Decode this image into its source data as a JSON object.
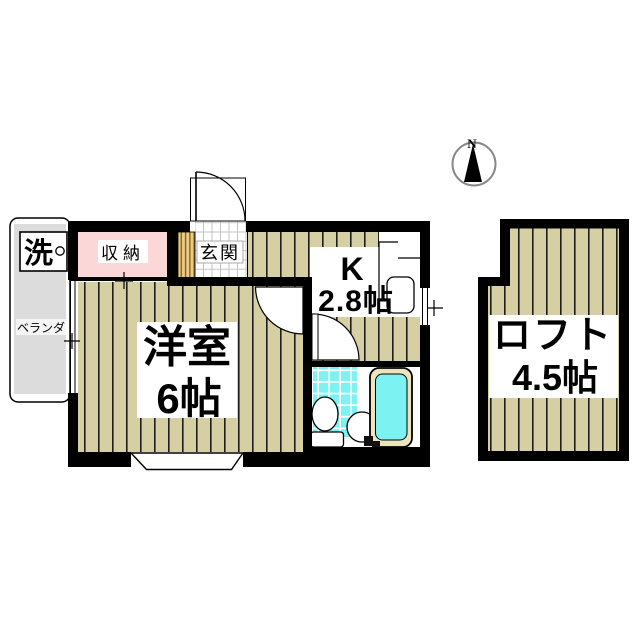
{
  "compass": {
    "north": "N"
  },
  "rooms": {
    "main_room": {
      "name": "洋室",
      "size": "6帖"
    },
    "kitchen": {
      "name": "K",
      "size": "2.8帖"
    },
    "loft": {
      "name": "ロフト",
      "size": "4.5帖"
    }
  },
  "labels": {
    "closet": "収納",
    "entrance": "玄関",
    "veranda": "ベランダ",
    "washer": "洗"
  },
  "colors": {
    "floor-beige": "#d6cfa4",
    "stripe-dark": "#1e1e1e",
    "closet-pink": "#fbd7d7",
    "tile-cyan": "#7df2f2",
    "tub-rim": "#ece4bc",
    "veranda-gray": "#dcdcdc",
    "shoe-tan": "#ecca80",
    "shoe-line": "#7a5c20",
    "wall-black": "#000000"
  }
}
